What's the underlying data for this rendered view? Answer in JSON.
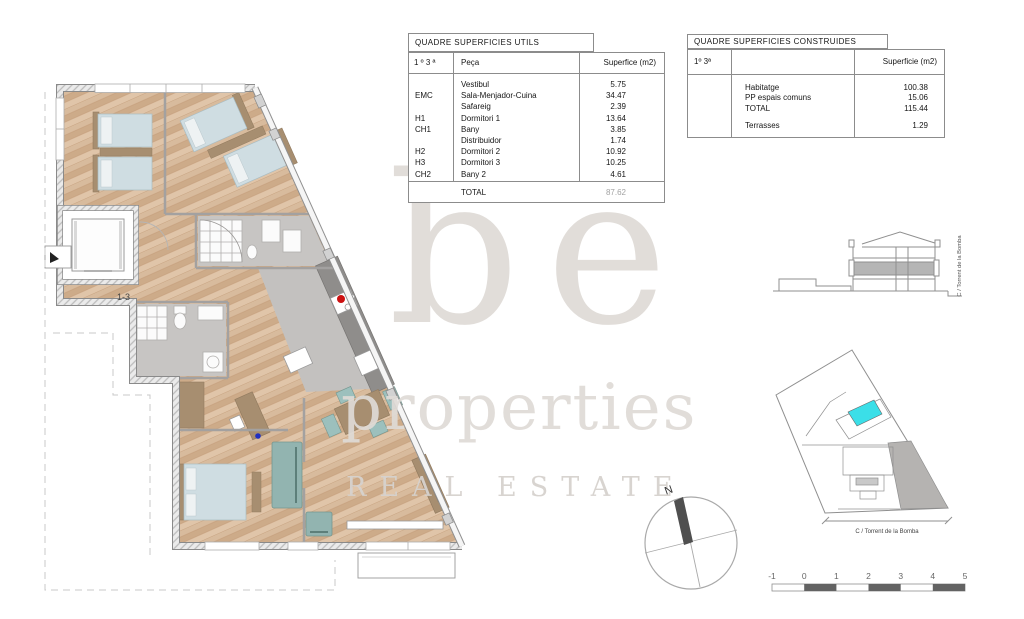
{
  "plan": {
    "unit_label": "1-3"
  },
  "tables": {
    "utils": {
      "title": "QUADRE SUPERFICIES UTILS",
      "columns": {
        "floor": "1 º 3 ª",
        "room": "Peça",
        "area": "Superfice (m2)"
      },
      "rows": [
        {
          "code": "",
          "name": "Vestibul",
          "value": "5.75"
        },
        {
          "code": "EMC",
          "name": "Sala-Menjador-Cuina",
          "value": "34.47"
        },
        {
          "code": "",
          "name": "Safareig",
          "value": "2.39"
        },
        {
          "code": "H1",
          "name": "Dormitori 1",
          "value": "13.64"
        },
        {
          "code": "CH1",
          "name": "Bany",
          "value": "3.85"
        },
        {
          "code": "",
          "name": "Distribuidor",
          "value": "1.74"
        },
        {
          "code": "H2",
          "name": "Dormitori 2",
          "value": "10.92"
        },
        {
          "code": "H3",
          "name": "Dormitori 3",
          "value": "10.25"
        },
        {
          "code": "CH2",
          "name": "Bany 2",
          "value": "4.61"
        }
      ],
      "total_label": "TOTAL",
      "total_value": "87.62"
    },
    "construides": {
      "title": "QUADRE SUPERFICIES CONSTRUIDES",
      "columns": {
        "floor": "1º 3ª",
        "area": "Superficie (m2)"
      },
      "rows": [
        {
          "name": "Habitatge",
          "value": "100.38"
        },
        {
          "name": "PP espais comuns",
          "value": "15.06"
        },
        {
          "name": "TOTAL",
          "value": "115.44"
        }
      ],
      "terrace_row": {
        "name": "Terrasses",
        "value": "1.29"
      }
    }
  },
  "watermark": {
    "line1": "be",
    "line2": "properties",
    "line3": "REAL ESTATE"
  },
  "compass": {
    "north_label": "N"
  },
  "site_plan": {
    "street_label": "C / Torrent de la Bomba",
    "highlight_color": "#3bdfe8"
  },
  "section": {
    "street_label": "C / Torrent de la Bomba"
  },
  "scalebar": {
    "labels": [
      "-1",
      "0",
      "1",
      "2",
      "3",
      "4",
      "5"
    ]
  },
  "colors": {
    "wood": "#d4b294",
    "wall": "#e3e3e3",
    "bed": "#cfdde2",
    "sofa": "#92b4b0",
    "furniture_tan": "#a78e70",
    "tile": "#c6c4c2",
    "counter": "#8f8d8b",
    "highlight_cyan": "#3bdfe8",
    "section_gray": "#b5b5b5",
    "scale_dark": "#636363"
  }
}
